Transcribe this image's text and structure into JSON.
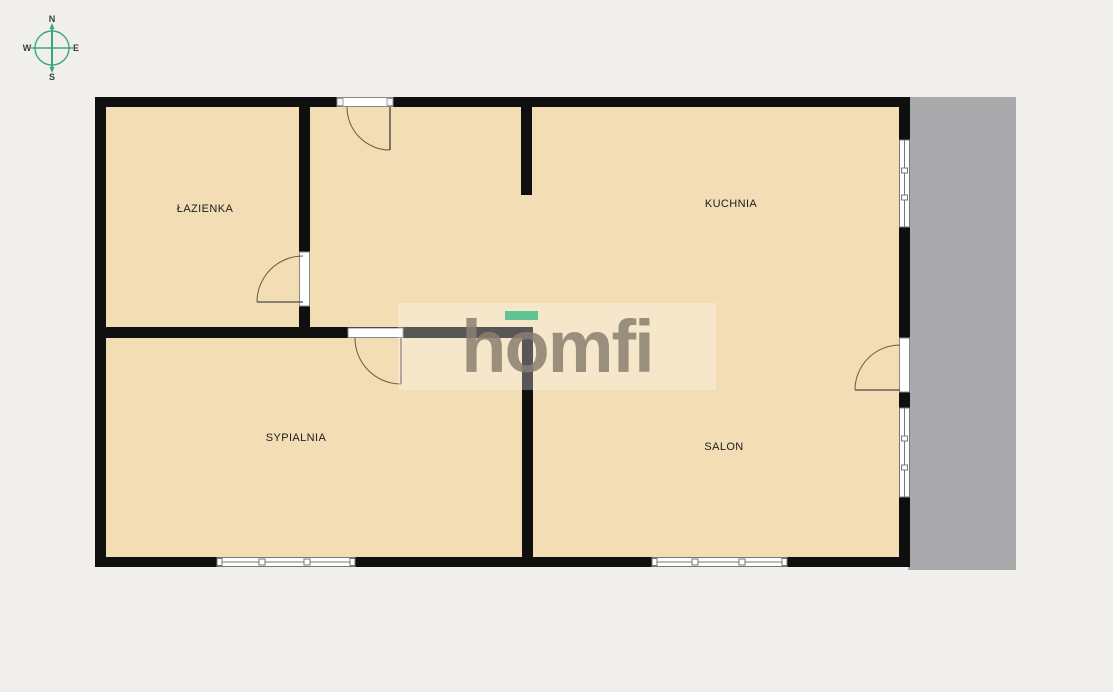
{
  "compass": {
    "north": "N",
    "east": "E",
    "south": "S",
    "west": "W"
  },
  "rooms": {
    "bathroom": {
      "label": "ŁAZIENKA"
    },
    "kitchen": {
      "label": "KUCHNIA"
    },
    "bedroom": {
      "label": "SYPIALNIA"
    },
    "living_room": {
      "label": "SALON"
    }
  },
  "watermark": {
    "brand": "homfi"
  },
  "colors": {
    "background": "#f1efeb",
    "floor": "#f3ddb5",
    "wall": "#0f0f0f",
    "balcony_gray": "#a9a9ab",
    "accent_green": "#57c28e",
    "compass_green": "#3aa876",
    "logo_gray": "#8a8070",
    "door_arc": "#6b5843"
  }
}
